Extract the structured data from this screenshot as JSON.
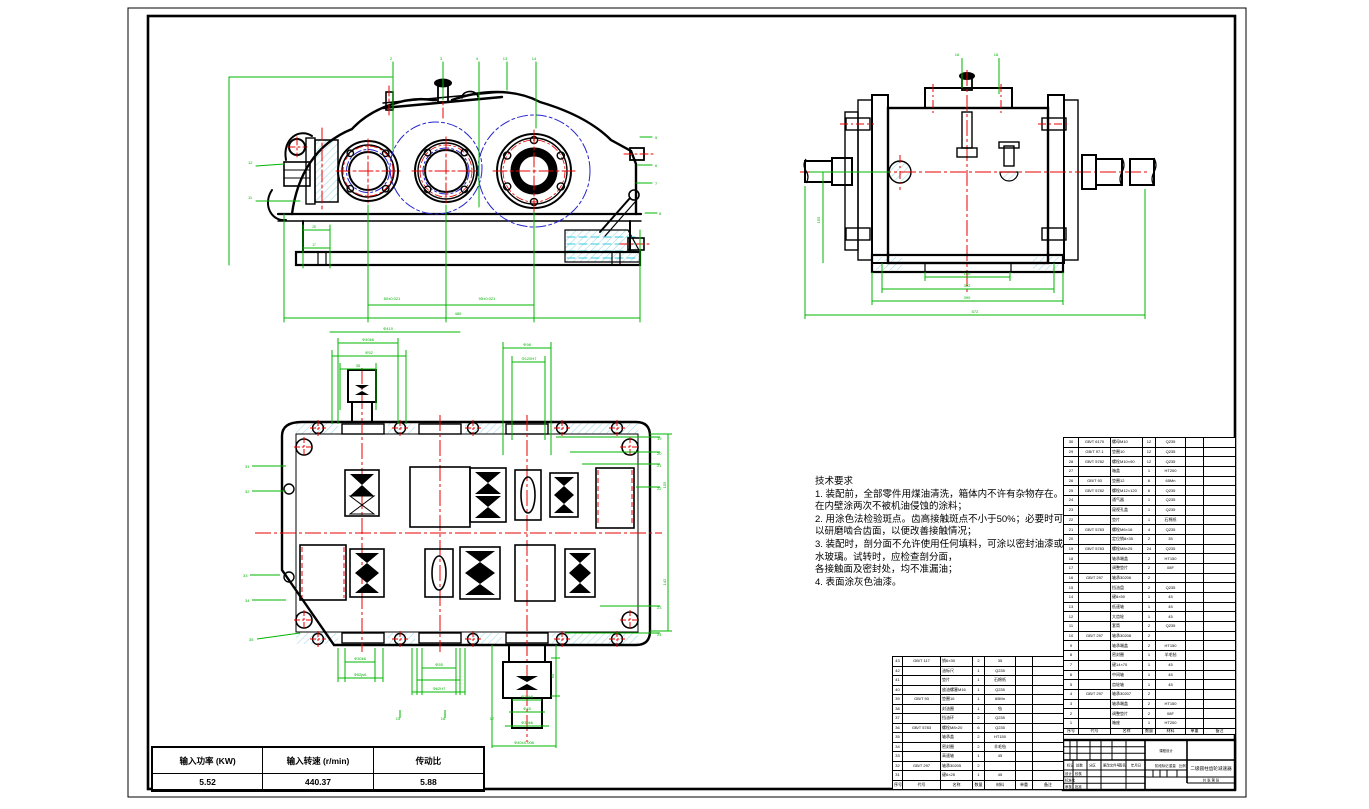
{
  "colors": {
    "line": "#000000",
    "dimension_green": "#00b400",
    "centerline_red": "#e80000",
    "pitch_blue": "#2424cc",
    "hatch_cyan": "#a5dcea",
    "oil_cyan": "#35c8dc",
    "paper": "#ffffff"
  },
  "tech_requirements": {
    "title": "技术要求",
    "lines": [
      "1. 装配前，全部零件用煤油清洗，箱体内不许有杂物存在。",
      "在内壁涂两次不被机油侵蚀的涂料；",
      "2. 用涂色法检验斑点。齿高接触斑点不小于50%；必要时可",
      "以研磨啮合齿面，以便改善接触情况；",
      "3. 装配时，剖分面不允许使用任何填料，可涂以密封油漆或",
      "水玻璃。试转时，应检查剖分面，",
      "各接触面及密封处，均不准漏油；",
      "4. 表面涂灰色油漆。"
    ]
  },
  "param_table": {
    "headers": [
      "输入功率 (KW)",
      "输入转速 (r/min)",
      "传动比"
    ],
    "values": [
      "5.52",
      "440.37",
      "5.88"
    ]
  },
  "tables": {
    "bom_right": {
      "header": [
        "序号",
        "代号",
        "名称",
        "数量",
        "材料",
        "单重",
        "备注"
      ],
      "rows": [
        [
          "30",
          "GB/T 6170",
          "螺母M10",
          "12",
          "Q235",
          "",
          ""
        ],
        [
          "29",
          "GB/T 97.1",
          "垫圈10",
          "12",
          "Q235",
          "",
          ""
        ],
        [
          "28",
          "GB/T 5782",
          "螺栓M10×90",
          "12",
          "Q235",
          "",
          ""
        ],
        [
          "27",
          "",
          "箱盖",
          "1",
          "HT200",
          "",
          ""
        ],
        [
          "26",
          "GB/T 93",
          "垫圈12",
          "6",
          "65Mn",
          "",
          ""
        ],
        [
          "25",
          "GB/T 5782",
          "螺栓M12×120",
          "6",
          "Q235",
          "",
          ""
        ],
        [
          "24",
          "",
          "通气器",
          "1",
          "Q235",
          "",
          ""
        ],
        [
          "23",
          "",
          "窥视孔盖",
          "1",
          "Q235",
          "",
          ""
        ],
        [
          "22",
          "",
          "垫片",
          "1",
          "石棉纸",
          "",
          ""
        ],
        [
          "21",
          "GB/T 5783",
          "螺栓M6×16",
          "4",
          "Q235",
          "",
          ""
        ],
        [
          "20",
          "",
          "定位销8×35",
          "2",
          "35",
          "",
          ""
        ],
        [
          "19",
          "GB/T 5783",
          "螺栓M8×25",
          "24",
          "Q235",
          "",
          ""
        ],
        [
          "18",
          "",
          "轴承端盖",
          "2",
          "HT150",
          "",
          ""
        ],
        [
          "17",
          "",
          "调整垫片",
          "2",
          "08F",
          "",
          ""
        ],
        [
          "16",
          "GB/T 297",
          "轴承30206",
          "2",
          "",
          "",
          ""
        ],
        [
          "15",
          "",
          "挡油盘",
          "2",
          "Q235",
          "",
          ""
        ],
        [
          "14",
          "",
          "键8×50",
          "1",
          "45",
          "",
          ""
        ],
        [
          "13",
          "",
          "低速轴",
          "1",
          "45",
          "",
          ""
        ],
        [
          "12",
          "",
          "大齿轮",
          "1",
          "45",
          "",
          ""
        ],
        [
          "11",
          "",
          "套筒",
          "2",
          "Q235",
          "",
          ""
        ],
        [
          "10",
          "GB/T 297",
          "轴承30208",
          "2",
          "",
          "",
          ""
        ],
        [
          "9",
          "",
          "轴承端盖",
          "2",
          "HT150",
          "",
          ""
        ],
        [
          "8",
          "",
          "密封圈",
          "1",
          "羊毛毡",
          "",
          ""
        ],
        [
          "7",
          "",
          "键14×70",
          "1",
          "45",
          "",
          ""
        ],
        [
          "6",
          "",
          "中间轴",
          "1",
          "45",
          "",
          ""
        ],
        [
          "5",
          "",
          "齿轮轴",
          "1",
          "45",
          "",
          ""
        ],
        [
          "4",
          "GB/T 297",
          "轴承30207",
          "2",
          "",
          "",
          ""
        ],
        [
          "3",
          "",
          "轴承端盖",
          "2",
          "HT150",
          "",
          ""
        ],
        [
          "2",
          "",
          "调整垫片",
          "2",
          "08F",
          "",
          ""
        ],
        [
          "1",
          "",
          "箱座",
          "1",
          "HT200",
          "",
          ""
        ]
      ]
    },
    "bom_lower": {
      "header": [
        "序号",
        "代号",
        "名称",
        "数量",
        "材料",
        "单重",
        "备注"
      ],
      "rows": [
        [
          "43",
          "GB/T 117",
          "销6×30",
          "2",
          "35",
          "",
          ""
        ],
        [
          "42",
          "",
          "油标尺",
          "1",
          "Q235",
          "",
          ""
        ],
        [
          "41",
          "",
          "垫片",
          "1",
          "石棉纸",
          "",
          ""
        ],
        [
          "40",
          "",
          "放油螺塞M16",
          "1",
          "Q235",
          "",
          ""
        ],
        [
          "39",
          "GB/T 93",
          "垫圈16",
          "1",
          "65Mn",
          "",
          ""
        ],
        [
          "38",
          "",
          "封油圈",
          "1",
          "毡",
          "",
          ""
        ],
        [
          "37",
          "",
          "挡油环",
          "2",
          "Q235",
          "",
          ""
        ],
        [
          "36",
          "GB/T 5783",
          "螺栓M8×20",
          "6",
          "Q235",
          "",
          ""
        ],
        [
          "35",
          "",
          "轴承盖",
          "2",
          "HT150",
          "",
          ""
        ],
        [
          "34",
          "",
          "密封圈",
          "2",
          "羊毛毡",
          "",
          ""
        ],
        [
          "33",
          "",
          "高速轴",
          "1",
          "45",
          "",
          ""
        ],
        [
          "32",
          "GB/T 297",
          "轴承30205",
          "2",
          "",
          "",
          ""
        ],
        [
          "31",
          "",
          "键6×25",
          "1",
          "45",
          "",
          ""
        ]
      ]
    }
  },
  "title_block": {
    "company": "课程设计",
    "name": "二级圆柱齿轮减速器",
    "sheet": "共 张 第 张",
    "rev_labels": [
      "标记",
      "处数",
      "分区",
      "更改文件号",
      "签名",
      "年月日"
    ],
    "role_labels": [
      "设计",
      "校核",
      "标准化",
      "审核",
      "批准"
    ],
    "stage_label": "阶段标记",
    "weight_label": "重量",
    "scale_label": "比例"
  },
  "balloons": {
    "fv_t1": "2",
    "fv_t2": "3",
    "fv_t3": "4",
    "fv_t4": "13",
    "fv_t5": "14",
    "fv_r1": "5",
    "fv_r2": "6",
    "fv_r3": "7",
    "fv_r4": "8",
    "fv_l1": "12",
    "fv_l2": "11",
    "sv_t1": "16",
    "sv_t2": "18",
    "tv_r1": "19",
    "tv_r2": "20",
    "tv_r3": "21",
    "tv_r4": "22",
    "tv_r5": "23",
    "tv_r6": "24",
    "tv_l1": "31",
    "tv_l2": "32",
    "tv_l3": "33",
    "tv_l4": "34",
    "tv_l5": "35",
    "tv_b1": "15",
    "tv_b2": "16",
    "tv_b3": "17"
  },
  "dims": {
    "fv_d1": "80±0.021",
    "fv_d2": "95±0.021",
    "fv_d3": "485",
    "fv_d4": "28",
    "fv_d5": "17",
    "fv_d6": "Φ410",
    "sv_d1": "140",
    "sv_d2": "302",
    "sv_d3": "390",
    "sv_d4": "572",
    "sv_d5": "155",
    "tv_d1": "Φ40k6",
    "tv_d2": "Φ52",
    "tv_d3": "35",
    "tv_d4": "Φ98",
    "tv_d5": "Φ120H7",
    "tv_d6": "155",
    "tv_d7": "142",
    "tv_d8": "Φ30k6",
    "tv_d9": "Φ52js6",
    "tv_d10": "Φ55",
    "tv_d11": "Φ62H7",
    "tv_d12": "60",
    "tv_d13": "Φ38k6",
    "tv_d14": "Φ45",
    "tv_d15": "Φ30k6",
    "tv_d16": "Φ40±0.008"
  }
}
